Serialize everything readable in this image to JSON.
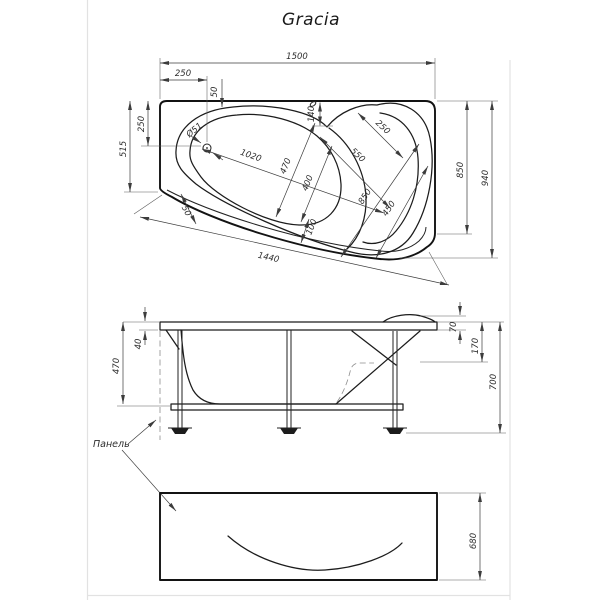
{
  "title": "Gracia",
  "top_view": {
    "width_total": "1500",
    "drain_offset_x": "250",
    "edge_50": "50",
    "head_gap_140": "140",
    "drain_offset_y": "250",
    "side_515": "515",
    "right_850": "850",
    "right_940": "940",
    "bottom_1440": "1440",
    "bowl_length_1020": "1020",
    "bowl_width_470": "470",
    "bowl_400": "400",
    "bowl_100": "100",
    "apron_50": "50",
    "seat_850": "850",
    "seat_450": "450",
    "seat_550": "550",
    "seat_250": "250",
    "drain_dia": "Ø51"
  },
  "front_view": {
    "body_470": "470",
    "rim_40": "40",
    "headrest_70": "70",
    "apron_top_170": "170",
    "height_700": "700",
    "panel_label": "Панель"
  },
  "panel_view": {
    "height_680": "680"
  }
}
